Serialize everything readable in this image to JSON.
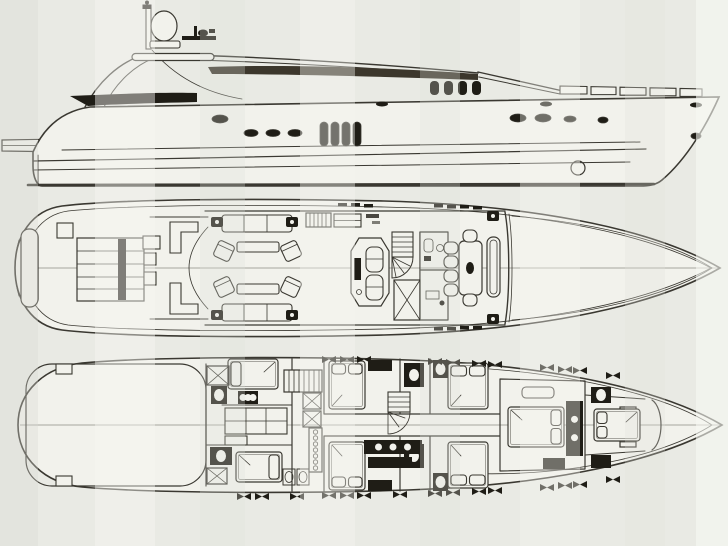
{
  "document": {
    "title": "Motor yacht general arrangement drawing (scanned, three stacked views, no legible text)",
    "views": [
      {
        "id": "profile",
        "label": "Side profile view"
      },
      {
        "id": "main-deck",
        "label": "Main deck plan"
      },
      {
        "id": "lower-deck",
        "label": "Lower deck plan"
      }
    ]
  },
  "colors": {
    "paper": "#e9eae4",
    "paper_light": "#f5f6f1",
    "paper_dark": "#dee0d9",
    "hull_fill": "#f2f2ec",
    "ink": "#3a3831",
    "ink_light": "#8e8d85",
    "dark_fill": "#1f1d16",
    "roof_fill": "#3c372c"
  },
  "profile": {
    "portholes": [
      {
        "cx": 220,
        "cy": 119,
        "rx": 8,
        "ry": 4
      },
      {
        "cx": 251,
        "cy": 133,
        "rx": 7,
        "ry": 3.5
      },
      {
        "cx": 273,
        "cy": 133,
        "rx": 7,
        "ry": 3.5
      },
      {
        "cx": 295,
        "cy": 133,
        "rx": 7,
        "ry": 3.5
      },
      {
        "cx": 518,
        "cy": 118,
        "rx": 8,
        "ry": 4
      },
      {
        "cx": 543,
        "cy": 118,
        "rx": 8,
        "ry": 4
      },
      {
        "cx": 570,
        "cy": 119,
        "rx": 6,
        "ry": 3
      },
      {
        "cx": 603,
        "cy": 120,
        "rx": 5,
        "ry": 3
      },
      {
        "cx": 696,
        "cy": 136,
        "rx": 5,
        "ry": 3
      }
    ],
    "hull_windows": [
      {
        "x": 320,
        "y": 122
      },
      {
        "x": 331,
        "y": 122
      },
      {
        "x": 342,
        "y": 122
      },
      {
        "x": 353,
        "y": 122
      }
    ],
    "hull_window_size": {
      "w": 8,
      "h": 24,
      "rx": 4
    },
    "cabin_windows": [
      {
        "x": 430,
        "y": 81
      },
      {
        "x": 444,
        "y": 81
      },
      {
        "x": 458,
        "y": 81
      },
      {
        "x": 472,
        "y": 81
      }
    ],
    "cabin_window_size": {
      "w": 9,
      "h": 14,
      "rx": 4
    },
    "deck_ovals": [
      {
        "cx": 382,
        "cy": 104
      },
      {
        "cx": 546,
        "cy": 104
      },
      {
        "cx": 696,
        "cy": 105
      }
    ],
    "bulwark_panes": [
      {
        "x": 560,
        "w": 27
      },
      {
        "x": 591,
        "w": 25
      },
      {
        "x": 620,
        "w": 26
      },
      {
        "x": 650,
        "w": 26
      },
      {
        "x": 680,
        "w": 22
      }
    ]
  },
  "main_deck": {
    "sunpad_stripes_y": [
      251,
      264,
      277,
      289
    ],
    "speakers": [
      {
        "x": 211,
        "y": 217
      },
      {
        "x": 286,
        "y": 217
      },
      {
        "x": 211,
        "y": 310
      },
      {
        "x": 286,
        "y": 310
      },
      {
        "x": 487,
        "y": 211
      },
      {
        "x": 487,
        "y": 314
      }
    ],
    "armchairs": [
      {
        "cx": 224,
        "cy": 251,
        "rot": 25
      },
      {
        "cx": 291,
        "cy": 251,
        "rot": -25
      },
      {
        "cx": 224,
        "cy": 287,
        "rot": -25
      },
      {
        "cx": 291,
        "cy": 287,
        "rot": 25
      }
    ],
    "dining_chairs": [
      {
        "cx": 451,
        "cy": 248
      },
      {
        "cx": 451,
        "cy": 262
      },
      {
        "cx": 451,
        "cy": 276
      },
      {
        "cx": 451,
        "cy": 290
      },
      {
        "cx": 470,
        "cy": 236
      },
      {
        "cx": 470,
        "cy": 300
      }
    ],
    "window_dashes": {
      "top": [
        {
          "x": 338,
          "y": 203
        },
        {
          "x": 351,
          "y": 203
        },
        {
          "x": 364,
          "y": 204
        },
        {
          "x": 434,
          "y": 204
        },
        {
          "x": 447,
          "y": 205
        },
        {
          "x": 460,
          "y": 205
        },
        {
          "x": 473,
          "y": 206
        }
      ],
      "bottom": [
        {
          "x": 434,
          "y": 327
        },
        {
          "x": 447,
          "y": 327
        },
        {
          "x": 460,
          "y": 326
        },
        {
          "x": 473,
          "y": 326
        }
      ]
    }
  },
  "lower_deck": {
    "beds": [
      {
        "x": 228,
        "y": 359,
        "w": 50,
        "h": 30,
        "pillow": "l",
        "n": 1
      },
      {
        "x": 236,
        "y": 452,
        "w": 46,
        "h": 30,
        "pillow": "r",
        "n": 1
      },
      {
        "x": 329,
        "y": 361,
        "w": 36,
        "h": 48,
        "pillow": "t",
        "n": 2
      },
      {
        "x": 329,
        "y": 442,
        "w": 36,
        "h": 48,
        "pillow": "b",
        "n": 2
      },
      {
        "x": 448,
        "y": 363,
        "w": 40,
        "h": 46,
        "pillow": "t",
        "n": 2
      },
      {
        "x": 448,
        "y": 442,
        "w": 40,
        "h": 46,
        "pillow": "b",
        "n": 2
      },
      {
        "x": 508,
        "y": 407,
        "w": 56,
        "h": 40,
        "pillow": "r",
        "n": 2
      },
      {
        "x": 594,
        "y": 409,
        "w": 46,
        "h": 32,
        "pillow": "l",
        "n": 2
      }
    ],
    "xboxes": [
      {
        "x": 207,
        "y": 366,
        "w": 22,
        "h": 19
      },
      {
        "x": 303,
        "y": 393,
        "w": 18,
        "h": 16
      },
      {
        "x": 303,
        "y": 411,
        "w": 18,
        "h": 16
      },
      {
        "x": 207,
        "y": 468,
        "w": 20,
        "h": 16
      }
    ],
    "dark_blocks": [
      {
        "x": 211,
        "y": 386,
        "w": 16,
        "h": 18,
        "oval": true
      },
      {
        "x": 238,
        "y": 391,
        "w": 20,
        "h": 13,
        "circles": 3
      },
      {
        "x": 210,
        "y": 447,
        "w": 22,
        "h": 18,
        "oval": true
      },
      {
        "x": 368,
        "y": 360,
        "w": 24,
        "h": 11
      },
      {
        "x": 368,
        "y": 480,
        "w": 24,
        "h": 11
      },
      {
        "x": 404,
        "y": 363,
        "w": 20,
        "h": 24,
        "oval": true
      },
      {
        "x": 404,
        "y": 444,
        "w": 20,
        "h": 24,
        "oval": true
      },
      {
        "x": 433,
        "y": 360,
        "w": 15,
        "h": 18,
        "oval": true
      },
      {
        "x": 433,
        "y": 473,
        "w": 15,
        "h": 18,
        "oval": true
      },
      {
        "x": 566,
        "y": 401,
        "w": 17,
        "h": 55,
        "circles": 2,
        "vertical": true
      },
      {
        "x": 543,
        "y": 458,
        "w": 22,
        "h": 11
      },
      {
        "x": 591,
        "y": 387,
        "w": 20,
        "h": 16,
        "oval": true
      },
      {
        "x": 591,
        "y": 455,
        "w": 20,
        "h": 13
      },
      {
        "x": 364,
        "y": 440,
        "w": 58,
        "h": 14,
        "circles": 3
      },
      {
        "x": 368,
        "y": 457,
        "w": 44,
        "h": 11
      }
    ],
    "sinks": [
      {
        "x": 283,
        "y": 469
      },
      {
        "x": 297,
        "y": 469
      }
    ],
    "dot_strip": {
      "x": 309,
      "y": 428,
      "w": 13,
      "h": 44,
      "dots": 7
    },
    "porthole_marks": {
      "top": [
        {
          "x": 322,
          "y": 356
        },
        {
          "x": 340,
          "y": 356
        },
        {
          "x": 357,
          "y": 356
        },
        {
          "x": 428,
          "y": 358
        },
        {
          "x": 446,
          "y": 359
        },
        {
          "x": 472,
          "y": 360
        },
        {
          "x": 488,
          "y": 361
        },
        {
          "x": 540,
          "y": 364
        },
        {
          "x": 558,
          "y": 366
        },
        {
          "x": 573,
          "y": 367
        },
        {
          "x": 606,
          "y": 372
        }
      ],
      "bottom": [
        {
          "x": 237,
          "y": 493
        },
        {
          "x": 255,
          "y": 493
        },
        {
          "x": 290,
          "y": 493
        },
        {
          "x": 322,
          "y": 492
        },
        {
          "x": 340,
          "y": 492
        },
        {
          "x": 357,
          "y": 492
        },
        {
          "x": 393,
          "y": 491
        },
        {
          "x": 428,
          "y": 490
        },
        {
          "x": 446,
          "y": 489
        },
        {
          "x": 472,
          "y": 488
        },
        {
          "x": 488,
          "y": 487
        },
        {
          "x": 540,
          "y": 484
        },
        {
          "x": 558,
          "y": 482
        },
        {
          "x": 573,
          "y": 481
        },
        {
          "x": 606,
          "y": 476
        }
      ]
    }
  }
}
